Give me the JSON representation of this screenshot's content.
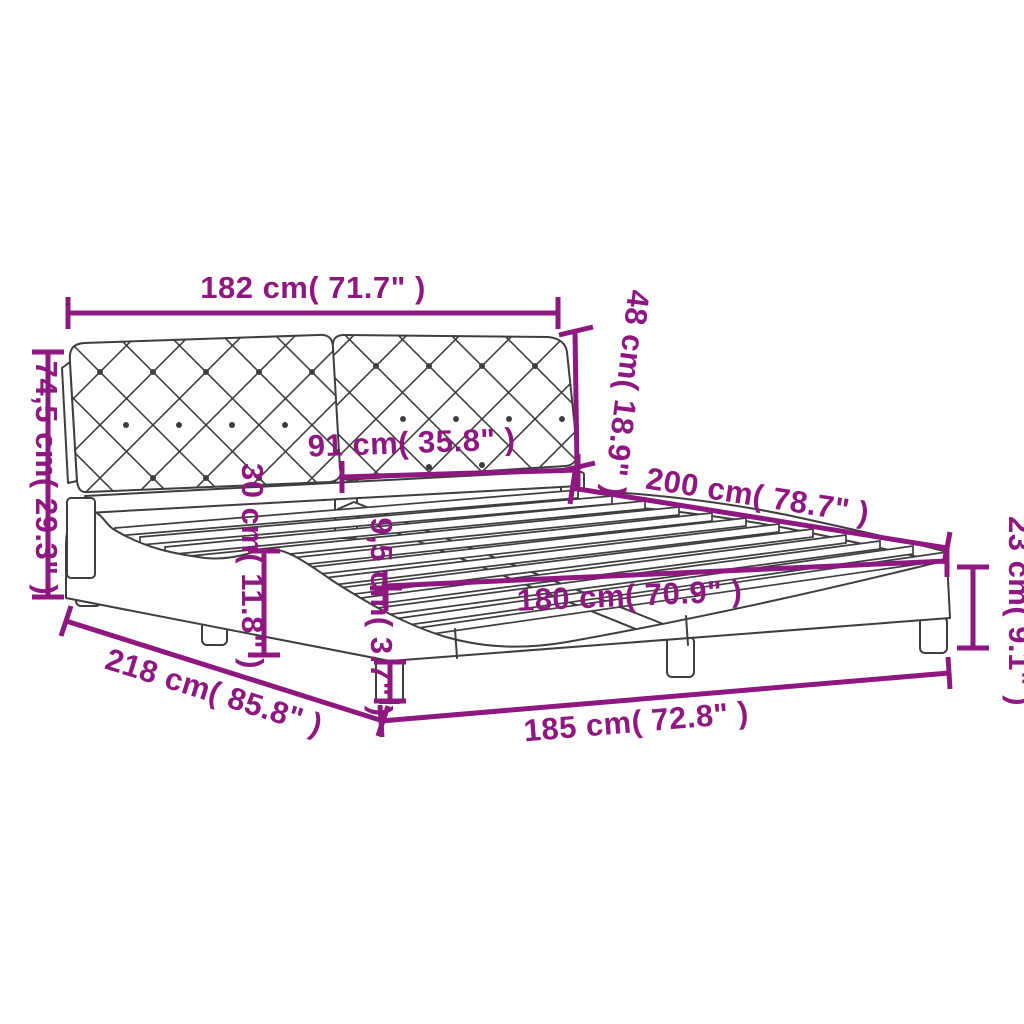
{
  "diagram": {
    "type": "product-dimension-diagram",
    "subject": "upholstered bed frame with tufted headboard and slatted base",
    "colors": {
      "dimension_accent": "#8E1780",
      "line_art": "#3E3E3E",
      "background": "#FFFFFF"
    },
    "dims": [
      {
        "name": "headboard-width",
        "label": "182 cm( 71.7\" )",
        "cm": "182",
        "inches": "71.7"
      },
      {
        "name": "headboard-panel-height",
        "label": "48 cm( 18.9\" )",
        "cm": "48",
        "inches": "18.9"
      },
      {
        "name": "headboard-total-height",
        "label": "74,5 cm( 29.3\" )",
        "cm": "74,5",
        "inches": "29.3"
      },
      {
        "name": "headboard-panel-width",
        "label": "91 cm( 35.8\" )",
        "cm": "91",
        "inches": "35.8"
      },
      {
        "name": "side-rail-height",
        "label": "30 cm( 11.8\" )",
        "cm": "30",
        "inches": "11.8"
      },
      {
        "name": "slat-frame-height",
        "label": "9,5 cm( 3.7\" )",
        "cm": "9,5",
        "inches": "3.7"
      },
      {
        "name": "mattress-length",
        "label": "200 cm( 78.7\" )",
        "cm": "200",
        "inches": "78.7"
      },
      {
        "name": "frame-side-height",
        "label": "23 cm( 9.1\" )",
        "cm": "23",
        "inches": "9.1"
      },
      {
        "name": "mattress-width",
        "label": "180 cm( 70.9\" )",
        "cm": "180",
        "inches": "70.9"
      },
      {
        "name": "total-length",
        "label": "218 cm( 85.8\" )",
        "cm": "218",
        "inches": "85.8"
      },
      {
        "name": "total-width",
        "label": "185 cm( 72.8\" )",
        "cm": "185",
        "inches": "72.8"
      }
    ]
  }
}
